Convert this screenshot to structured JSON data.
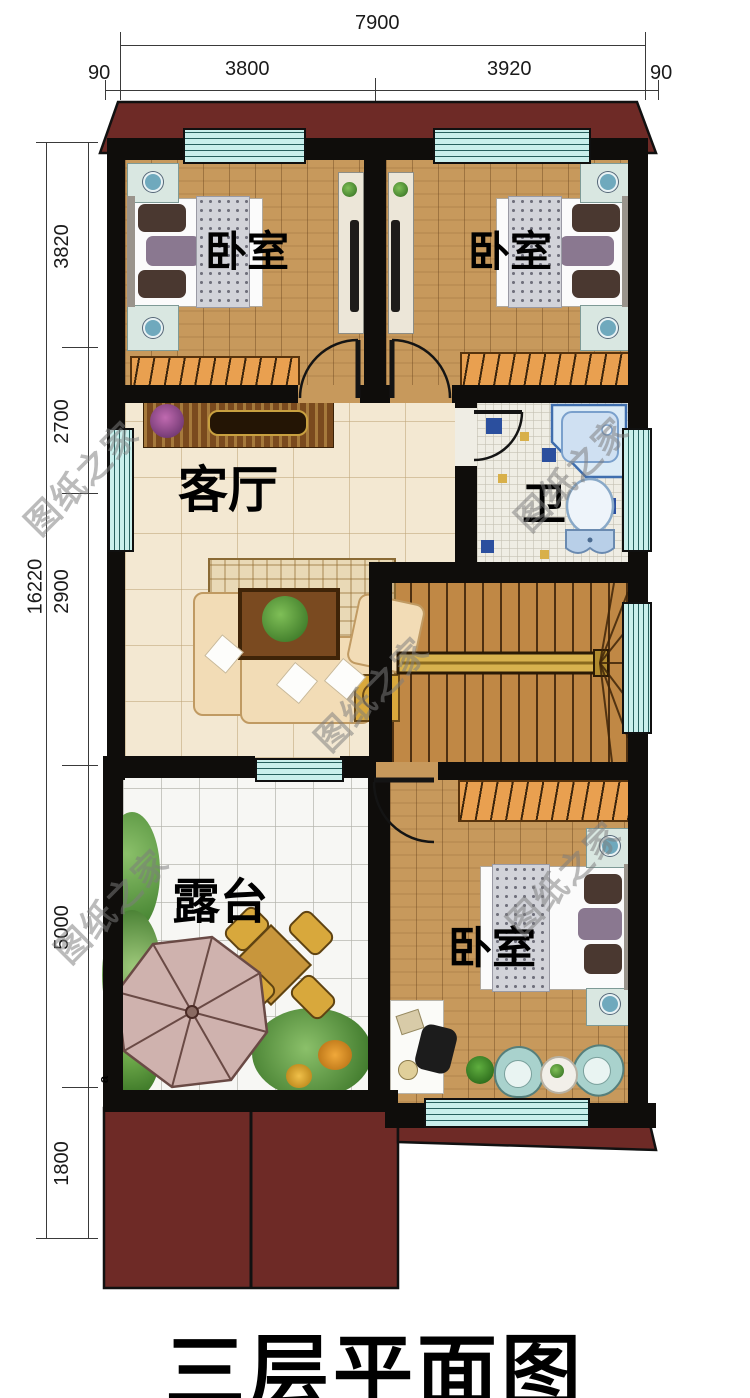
{
  "title": "三层平面图",
  "watermark_text": "图纸之家",
  "rooms": {
    "bedroom_top_left": "卧室",
    "bedroom_top_right": "卧室",
    "living_room": "客厅",
    "bathroom": "卫",
    "terrace": "露台",
    "bedroom_bottom": "卧室"
  },
  "dimensions": {
    "top": {
      "total": "7900",
      "segments": [
        "90",
        "3800",
        "3920",
        "90"
      ]
    },
    "left": {
      "total": "16220",
      "segments": [
        "3820",
        "2700",
        "2900",
        "5000",
        "1800"
      ]
    }
  },
  "annotations": {
    "corner_letter": "a"
  },
  "colors": {
    "roof": "#6e2a26",
    "wall": "#0f0d0b",
    "wood_floor": "#c7995c",
    "living_floor": "#f3e8d2",
    "terrace_floor": "#f7f7f4",
    "bathroom_floor": "#efede4",
    "window": "#c9efec",
    "wardrobe": "#e9a050",
    "stairs": "#c08845",
    "accent_blue": "#2b4f9e",
    "accent_yellow": "#d8b04a"
  }
}
